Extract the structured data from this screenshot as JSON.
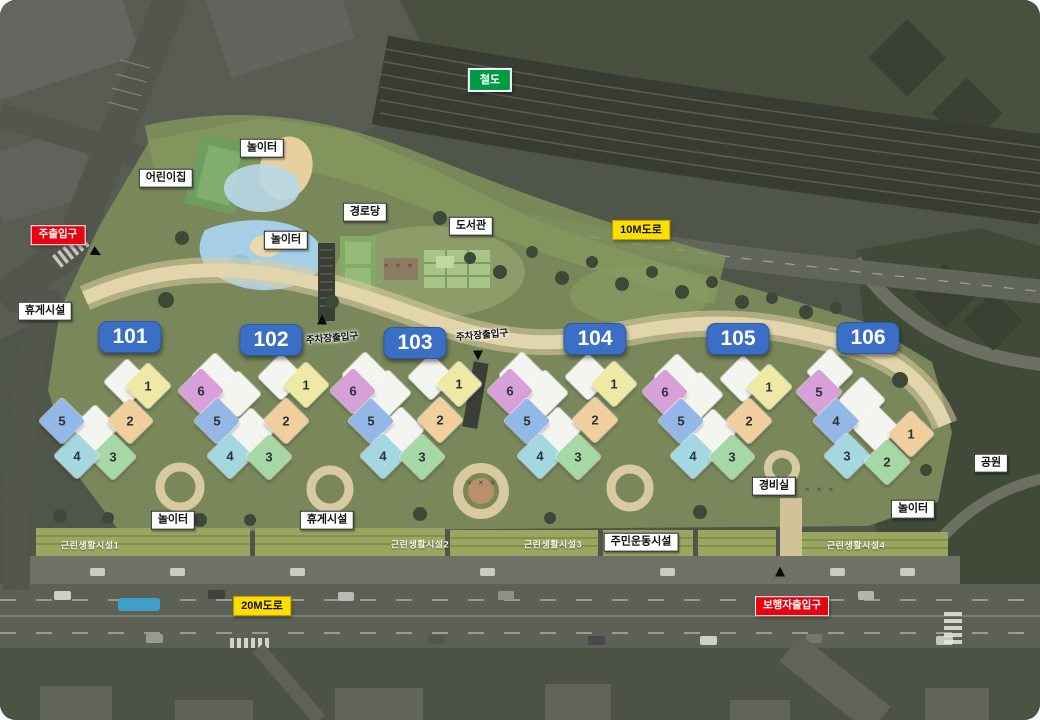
{
  "map": {
    "colors": {
      "badge_blue": "#3a6fc5",
      "badge_red": "#e60210",
      "badge_yellow": "#ffdf00",
      "badge_green": "#009a40",
      "yellow": "#eee9a4",
      "tan": "#f1cf9d",
      "green": "#a5d8a5",
      "cyan": "#a4d7e0",
      "blue": "#93b7e6",
      "magenta": "#d7a0d8",
      "roof_white": "#f4f4f1"
    },
    "badges": [
      {
        "id": "railway",
        "type": "green",
        "text": "철도",
        "x": 490,
        "y": 80
      },
      {
        "id": "road-10m",
        "type": "yellow",
        "text": "10M도로",
        "x": 641,
        "y": 230
      },
      {
        "id": "road-20m",
        "type": "yellow",
        "text": "20M도로",
        "x": 262,
        "y": 606
      },
      {
        "id": "main-entrance",
        "type": "red",
        "text": "주출입구",
        "x": 58,
        "y": 235
      },
      {
        "id": "pedestrian-entrance",
        "type": "red",
        "text": "보행자출입구",
        "x": 792,
        "y": 606
      }
    ],
    "building_badges": [
      {
        "label": "101",
        "x": 130,
        "y": 337
      },
      {
        "label": "102",
        "x": 271,
        "y": 340
      },
      {
        "label": "103",
        "x": 415,
        "y": 343
      },
      {
        "label": "104",
        "x": 595,
        "y": 339
      },
      {
        "label": "105",
        "x": 738,
        "y": 339
      },
      {
        "label": "106",
        "x": 868,
        "y": 338
      }
    ],
    "white_labels": [
      {
        "id": "playground-top",
        "text": "놀이터",
        "x": 262,
        "y": 148
      },
      {
        "id": "daycare",
        "text": "어린이집",
        "x": 166,
        "y": 178
      },
      {
        "id": "playground-mid",
        "text": "놀이터",
        "x": 286,
        "y": 240
      },
      {
        "id": "senior-center",
        "text": "경로당",
        "x": 365,
        "y": 212
      },
      {
        "id": "library",
        "text": "도서관",
        "x": 471,
        "y": 226
      },
      {
        "id": "rest-area-left",
        "text": "휴게시설",
        "x": 45,
        "y": 311
      },
      {
        "id": "park",
        "text": "공원",
        "x": 991,
        "y": 463
      },
      {
        "id": "security-office",
        "text": "경비실",
        "x": 774,
        "y": 486
      },
      {
        "id": "playground-right",
        "text": "놀이터",
        "x": 913,
        "y": 509
      },
      {
        "id": "playground-bottom",
        "text": "놀이터",
        "x": 173,
        "y": 520
      },
      {
        "id": "rest-area-bottom",
        "text": "휴게시설",
        "x": 327,
        "y": 520
      },
      {
        "id": "exercise-facility",
        "text": "주민운동시설",
        "x": 641,
        "y": 542
      }
    ],
    "ground_labels": [
      {
        "id": "parking-entrance-1",
        "style": "dark",
        "text": "주차장출입구",
        "x": 332,
        "y": 337,
        "rot": -5
      },
      {
        "id": "parking-entrance-2",
        "style": "dark",
        "text": "주차장출입구",
        "x": 482,
        "y": 334,
        "rot": -5
      },
      {
        "id": "retail-1",
        "style": "light",
        "text": "근린생활시설1",
        "x": 90,
        "y": 545,
        "rot": 0
      },
      {
        "id": "retail-2",
        "style": "light",
        "text": "근린생활시설2",
        "x": 420,
        "y": 544,
        "rot": 0
      },
      {
        "id": "retail-3",
        "style": "light",
        "text": "근린생활시설3",
        "x": 553,
        "y": 544,
        "rot": 0
      },
      {
        "id": "retail-4",
        "style": "light",
        "text": "근린생활시설4",
        "x": 856,
        "y": 545,
        "rot": 0
      }
    ],
    "arrows": [
      {
        "id": "main-entrance-arrow",
        "dir": "right",
        "glyph": "▲",
        "x": 97,
        "y": 253,
        "rot": 118
      },
      {
        "id": "parking-1-arrow",
        "dir": "up",
        "glyph": "▲",
        "x": 322,
        "y": 319,
        "rot": 0
      },
      {
        "id": "parking-2-arrow",
        "dir": "down",
        "glyph": "▲",
        "x": 478,
        "y": 356,
        "rot": 180
      },
      {
        "id": "pedestrian-arrow",
        "dir": "up",
        "glyph": "▲",
        "x": 780,
        "y": 571,
        "rot": 0
      }
    ],
    "decor_marks": [
      {
        "text": "✕ ✕ ✕",
        "x": 399,
        "y": 266
      },
      {
        "text": "✕ ✕ ✕",
        "x": 482,
        "y": 483
      },
      {
        "text": "✕ ✕ ✕",
        "x": 820,
        "y": 490
      }
    ],
    "clusters": [
      {
        "id": "101",
        "units": [
          {
            "n": "1",
            "c": "yellow",
            "x": 148,
            "y": 386
          },
          {
            "n": "2",
            "c": "tan",
            "x": 130,
            "y": 421
          },
          {
            "n": "3",
            "c": "green",
            "x": 113,
            "y": 457
          },
          {
            "n": "4",
            "c": "cyan",
            "x": 77,
            "y": 456
          },
          {
            "n": "5",
            "c": "blue",
            "x": 62,
            "y": 421
          }
        ],
        "whites": [
          [
            127,
            382
          ],
          [
            95,
            428
          ]
        ]
      },
      {
        "id": "102",
        "units": [
          {
            "n": "6",
            "c": "magenta",
            "x": 201,
            "y": 391
          },
          {
            "n": "5",
            "c": "blue",
            "x": 217,
            "y": 421
          },
          {
            "n": "4",
            "c": "cyan",
            "x": 230,
            "y": 456
          },
          {
            "n": "3",
            "c": "green",
            "x": 269,
            "y": 457
          },
          {
            "n": "2",
            "c": "tan",
            "x": 286,
            "y": 421
          },
          {
            "n": "1",
            "c": "yellow",
            "x": 306,
            "y": 385
          }
        ],
        "whites": [
          [
            215,
            376
          ],
          [
            238,
            394
          ],
          [
            281,
            377
          ],
          [
            251,
            431
          ]
        ]
      },
      {
        "id": "103",
        "units": [
          {
            "n": "6",
            "c": "magenta",
            "x": 353,
            "y": 391
          },
          {
            "n": "5",
            "c": "blue",
            "x": 371,
            "y": 421
          },
          {
            "n": "4",
            "c": "cyan",
            "x": 383,
            "y": 456
          },
          {
            "n": "3",
            "c": "green",
            "x": 422,
            "y": 457
          },
          {
            "n": "2",
            "c": "tan",
            "x": 440,
            "y": 420
          },
          {
            "n": "1",
            "c": "yellow",
            "x": 459,
            "y": 384
          }
        ],
        "whites": [
          [
            365,
            375
          ],
          [
            388,
            393
          ],
          [
            431,
            377
          ],
          [
            401,
            430
          ]
        ]
      },
      {
        "id": "104",
        "units": [
          {
            "n": "6",
            "c": "magenta",
            "x": 510,
            "y": 391
          },
          {
            "n": "5",
            "c": "blue",
            "x": 527,
            "y": 421
          },
          {
            "n": "4",
            "c": "cyan",
            "x": 540,
            "y": 456
          },
          {
            "n": "3",
            "c": "green",
            "x": 578,
            "y": 457
          },
          {
            "n": "2",
            "c": "tan",
            "x": 595,
            "y": 420
          },
          {
            "n": "1",
            "c": "yellow",
            "x": 614,
            "y": 384
          }
        ],
        "whites": [
          [
            522,
            375
          ],
          [
            545,
            393
          ],
          [
            588,
            377
          ],
          [
            558,
            430
          ]
        ]
      },
      {
        "id": "105",
        "units": [
          {
            "n": "6",
            "c": "magenta",
            "x": 665,
            "y": 392
          },
          {
            "n": "5",
            "c": "blue",
            "x": 681,
            "y": 421
          },
          {
            "n": "4",
            "c": "cyan",
            "x": 693,
            "y": 456
          },
          {
            "n": "3",
            "c": "green",
            "x": 732,
            "y": 457
          },
          {
            "n": "2",
            "c": "tan",
            "x": 749,
            "y": 421
          },
          {
            "n": "1",
            "c": "yellow",
            "x": 769,
            "y": 387
          }
        ],
        "whites": [
          [
            677,
            377
          ],
          [
            700,
            395
          ],
          [
            743,
            379
          ],
          [
            713,
            432
          ]
        ]
      },
      {
        "id": "106",
        "units": [
          {
            "n": "5",
            "c": "magenta",
            "x": 819,
            "y": 392
          },
          {
            "n": "4",
            "c": "blue",
            "x": 836,
            "y": 421
          },
          {
            "n": "3",
            "c": "cyan",
            "x": 847,
            "y": 456
          },
          {
            "n": "2",
            "c": "green",
            "x": 887,
            "y": 462
          },
          {
            "n": "1",
            "c": "tan",
            "x": 911,
            "y": 434
          }
        ],
        "whites": [
          [
            830,
            372
          ],
          [
            862,
            400
          ],
          [
            876,
            428
          ]
        ]
      }
    ]
  }
}
